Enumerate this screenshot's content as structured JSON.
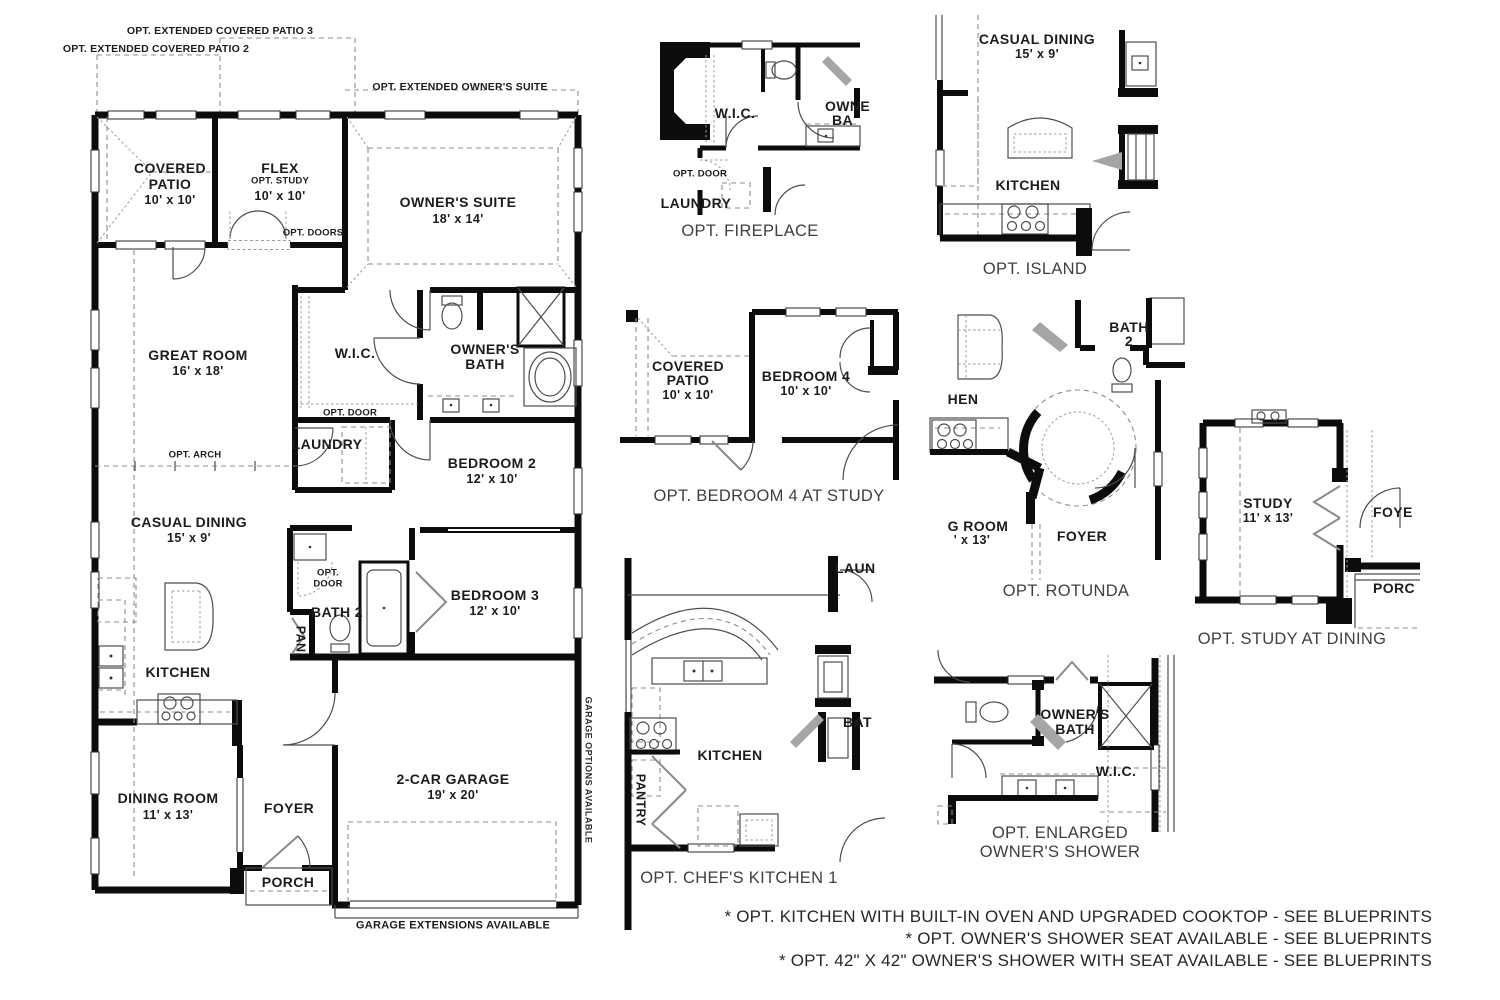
{
  "colors": {
    "wall": "#0c0c0c",
    "text": "#1c1c1c",
    "caption": "#3f3f3f",
    "dashed": "#8c8c8c"
  },
  "main_plan": {
    "extended_options": {
      "patio3": "OPT. EXTENDED COVERED PATIO 3",
      "patio2": "OPT. EXTENDED COVERED PATIO 2",
      "owners_suite": "OPT. EXTENDED OWNER'S SUITE"
    },
    "rooms": {
      "covered_patio": {
        "name1": "COVERED",
        "name2": "PATIO",
        "dims": "10' x 10'"
      },
      "flex": {
        "name": "FLEX",
        "sub": "OPT. STUDY",
        "dims": "10' x 10'"
      },
      "owners_suite": {
        "name": "OWNER'S SUITE",
        "dims": "18' x 14'"
      },
      "great_room": {
        "name": "GREAT ROOM",
        "dims": "16' x 18'"
      },
      "wic": {
        "name": "W.I.C."
      },
      "owners_bath": {
        "name1": "OWNER'S",
        "name2": "BATH"
      },
      "laundry": {
        "name": "LAUNDRY"
      },
      "bedroom2": {
        "name": "BEDROOM 2",
        "dims": "12' x 10'"
      },
      "casual_dining": {
        "name": "CASUAL DINING",
        "dims": "15' x 9'"
      },
      "bath2": {
        "name": "BATH 2"
      },
      "pantry": {
        "name": "PAN."
      },
      "bedroom3": {
        "name": "BEDROOM 3",
        "dims": "12' x 10'"
      },
      "kitchen": {
        "name": "KITCHEN"
      },
      "dining_room": {
        "name": "DINING ROOM",
        "dims": "11' x 13'"
      },
      "foyer": {
        "name": "FOYER"
      },
      "garage": {
        "name": "2-CAR GARAGE",
        "dims": "19' x 20'"
      },
      "porch": {
        "name": "PORCH"
      }
    },
    "annotations": {
      "opt_doors": "OPT. DOORS",
      "opt_door_laundry": "OPT. DOOR",
      "opt_arch": "OPT. ARCH",
      "opt_door_bath_1": "OPT.",
      "opt_door_bath_2": "DOOR",
      "garage_options": "GARAGE OPTIONS AVAILABLE",
      "garage_extensions": "GARAGE EXTENSIONS AVAILABLE"
    }
  },
  "details": {
    "fireplace": {
      "caption": "OPT. FIREPLACE",
      "wic": "W.I.C.",
      "owners_bath_clip1": "OWNE",
      "owners_bath_clip2": "BA",
      "opt_door": "OPT. DOOR",
      "laundry": "LAUNDRY"
    },
    "island": {
      "caption": "OPT. ISLAND",
      "casual_dining": "CASUAL DINING",
      "casual_dining_dims": "15' x 9'",
      "kitchen": "KITCHEN"
    },
    "bedroom4": {
      "caption": "OPT. BEDROOM 4 AT STUDY",
      "covered": "COVERED",
      "patio": "PATIO",
      "patio_dims": "10' x 10'",
      "bedroom": "BEDROOM 4",
      "bedroom_dims": "10' x 10'"
    },
    "rotunda": {
      "caption": "OPT. ROTUNDA",
      "bath": "BATH",
      "bath_num": "2",
      "kitchen_clip": "HEN",
      "dining_clip": "G ROOM",
      "dining_dims_clip": "' x 13'",
      "foyer": "FOYER"
    },
    "study": {
      "caption": "OPT. STUDY AT DINING",
      "study": "STUDY",
      "study_dims": "11' x 13'",
      "foyer_clip": "FOYE",
      "porch_clip": "PORC"
    },
    "chefs_kitchen": {
      "caption": "OPT. CHEF'S KITCHEN 1",
      "kitchen": "KITCHEN",
      "laundry_clip": "LAUN",
      "bath_clip": "BAT",
      "pantry": "PANTRY"
    },
    "enlarged_shower": {
      "caption1": "OPT. ENLARGED",
      "caption2": "OWNER'S SHOWER",
      "owners": "OWNER'S",
      "bath": "BATH",
      "wic": "W.I.C."
    }
  },
  "footnotes": {
    "line1": "* OPT. KITCHEN WITH BUILT-IN OVEN AND UPGRADED COOKTOP - SEE BLUEPRINTS",
    "line2": "* OPT. OWNER'S SHOWER SEAT AVAILABLE - SEE BLUEPRINTS",
    "line3": "* OPT. 42\" X 42\" OWNER'S SHOWER WITH SEAT AVAILABLE - SEE BLUEPRINTS"
  }
}
